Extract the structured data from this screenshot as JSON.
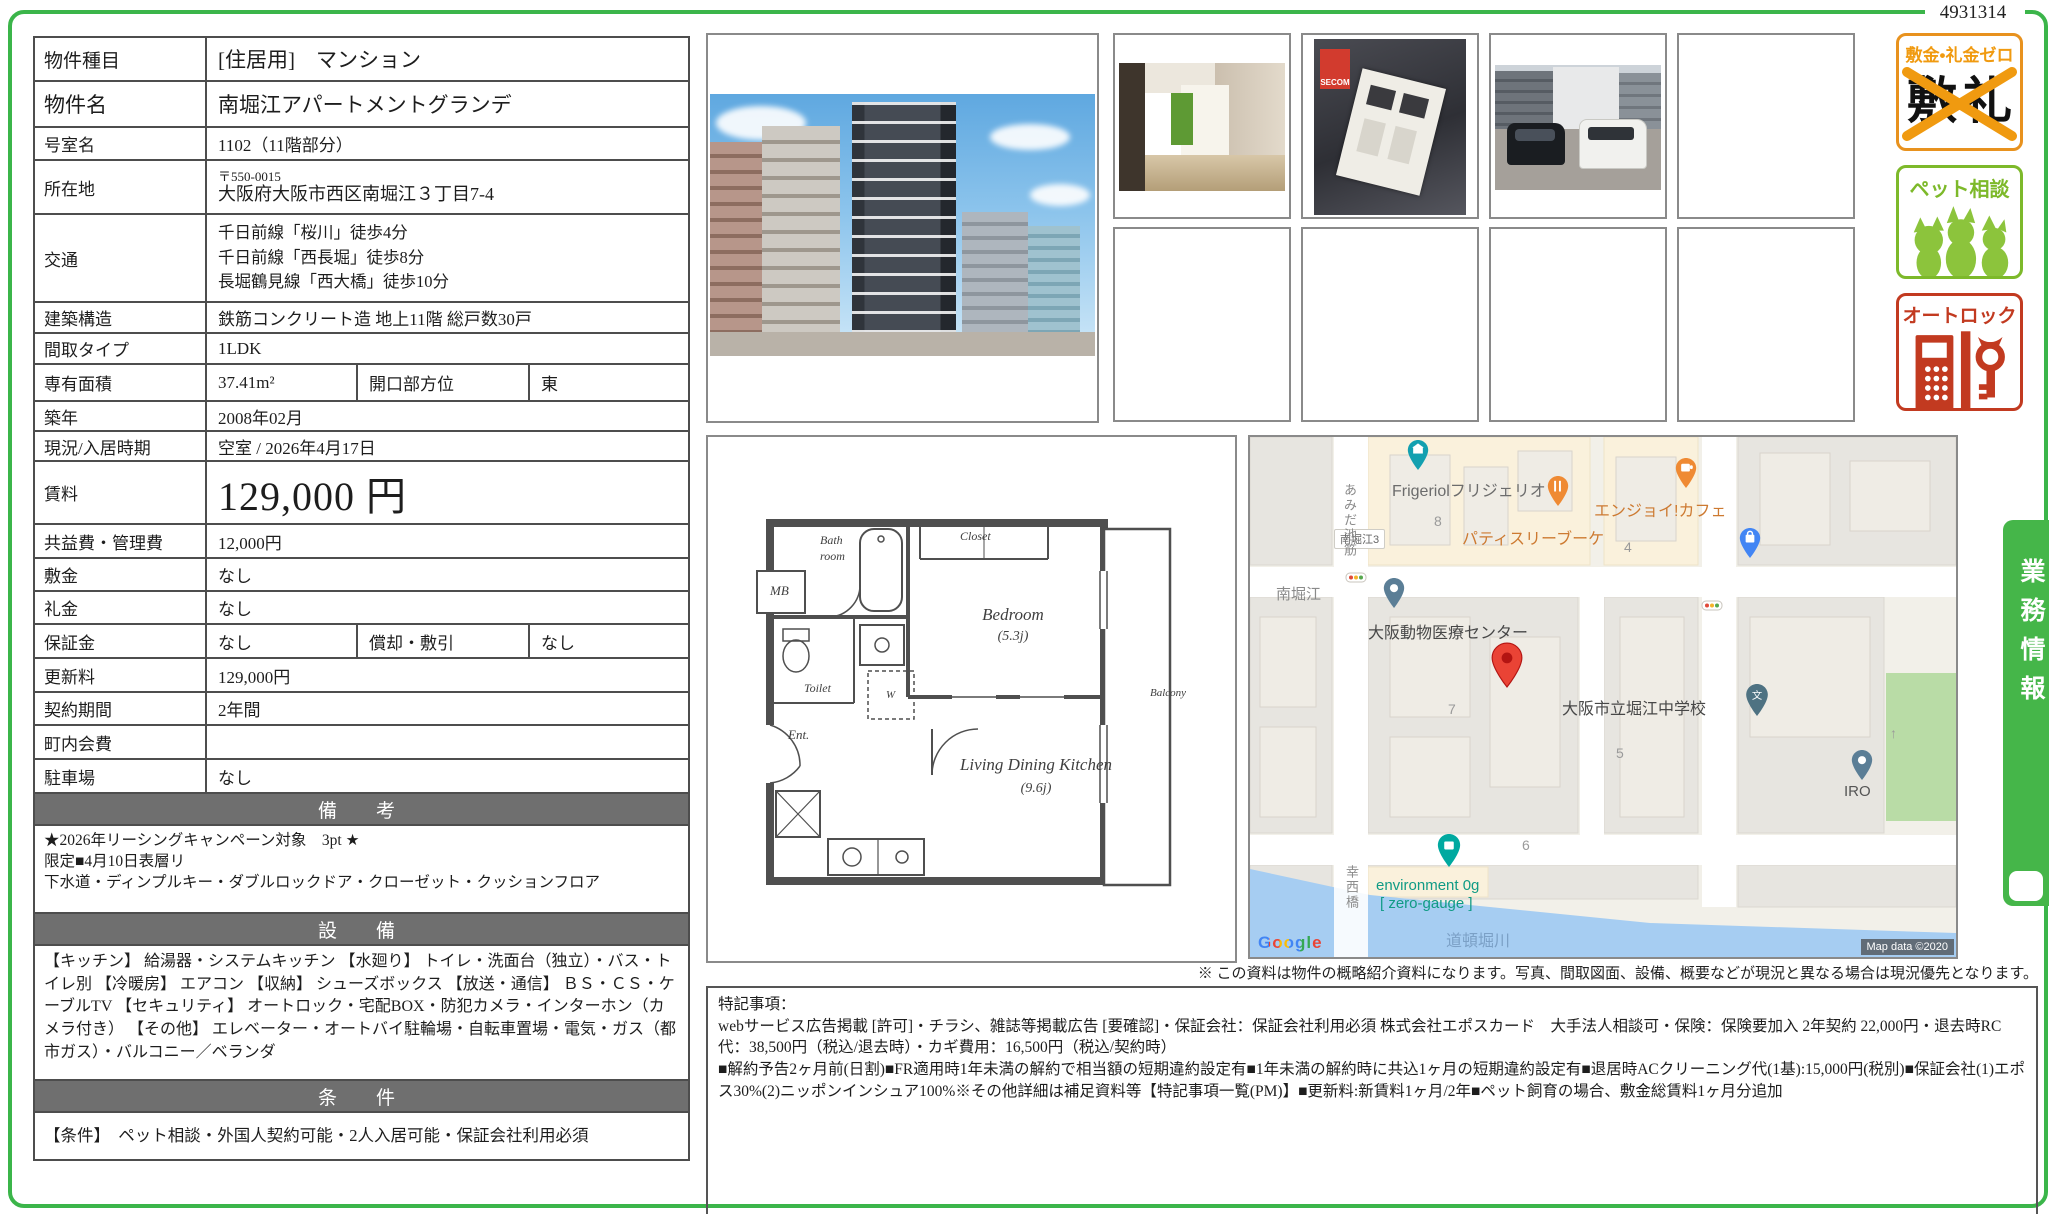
{
  "page": {
    "id_number": "4931314",
    "disclaimer": "※ この資料は物件の概略紹介資料になります。写真、間取図面、設備、概要などが現況と異なる場合は現況優先となります。"
  },
  "table": {
    "rows": [
      {
        "label": "物件種目",
        "value": "[住居用]　マンション"
      },
      {
        "label": "物件名",
        "value": "南堀江アパートメントグランデ"
      },
      {
        "label": "号室名",
        "value": "1102（11階部分）"
      },
      {
        "label": "所在地",
        "postal": "〒550-0015",
        "value": "大阪府大阪市西区南堀江３丁目7-4"
      },
      {
        "label": "交通",
        "line1": "千日前線「桜川」徒歩4分",
        "line2": "千日前線「西長堀」徒歩8分",
        "line3": "長堀鶴見線「西大橋」徒歩10分"
      },
      {
        "label": "建築構造",
        "value": "鉄筋コンクリート造 地上11階 総戸数30戸"
      },
      {
        "label": "間取タイプ",
        "value": "1LDK"
      },
      {
        "label": "専有面積",
        "value": "37.41m²",
        "label2": "開口部方位",
        "value2": "東"
      },
      {
        "label": "築年",
        "value": "2008年02月"
      },
      {
        "label": "現況/入居時期",
        "value": "空室 / 2026年4月17日"
      },
      {
        "label": "賃料",
        "value": "129,000 円"
      },
      {
        "label": "共益費・管理費",
        "value": "12,000円"
      },
      {
        "label": "敷金",
        "value": "なし"
      },
      {
        "label": "礼金",
        "value": "なし"
      },
      {
        "label": "保証金",
        "value": "なし",
        "label2": "償却・敷引",
        "value2": "なし"
      },
      {
        "label": "更新料",
        "value": "129,000円"
      },
      {
        "label": "契約期間",
        "value": "2年間"
      },
      {
        "label": "町内会費",
        "value": ""
      },
      {
        "label": "駐車場",
        "value": "なし"
      }
    ],
    "sections": {
      "remarks_header": "備　考",
      "remarks_line1": "★2026年リーシングキャンペーン対象　3pt ★",
      "remarks_line2": "限定■4月10日表層リ",
      "remarks_line3": "下水道・ディンプルキー・ダブルロックドア・クローゼット・クッションフロア",
      "equipment_header": "設　備",
      "equipment_text": "【キッチン】 給湯器・システムキッチン 【水廻り】 トイレ・洗面台（独立）・バス・トイレ別 【冷暖房】 エアコン 【収納】 シューズボックス 【放送・通信】 ＢＳ・ＣＳ・ケーブルTV 【セキュリティ】 オートロック・宅配BOX・防犯カメラ・インターホン（カメラ付き） 【その他】 エレベーター・オートバイ駐輪場・自転車置場・電気・ガス（都市ガス）・バルコニー／ベランダ",
      "conditions_header": "条　件",
      "conditions_text": "【条件】　ペット相談・外国人契約可能・2人入居可能・保証会社利用必須"
    }
  },
  "photos": {
    "secom_label": "SECOM"
  },
  "floorplan": {
    "mb": "MB",
    "bath1": "Bath",
    "bath2": "room",
    "closet": "Closet",
    "bedroom": "Bedroom",
    "bedroom_size": "(5.3j)",
    "toilet": "Toilet",
    "washer": "W",
    "entrance": "Ent.",
    "ldk": "Living Dining Kitchen",
    "ldk_size": "(9.6j)",
    "balcony": "Balcony"
  },
  "map": {
    "frigeriol": "Frigeriolフリジェリオ",
    "block8": "8",
    "block4": "4",
    "block7": "7",
    "block5": "5",
    "block6": "6",
    "patisserie": "パティスリーブーケ",
    "cafe": "エンジョイ!カフェ",
    "sign": "南堀江3",
    "minamihorie": "南堀江",
    "amidasuji": "あみだ池筋",
    "hospital": "大阪動物医療センター",
    "school": "大阪市立堀江中学校",
    "school_mark": "文",
    "env1": "environment 0g",
    "env2": "[ zero-gauge ]",
    "bridge": "幸西橋",
    "river": "道頓堀川",
    "iro": "IRO",
    "arrow": "↑",
    "google": "Google",
    "attribution": "Map data ©2020"
  },
  "badges": {
    "b1_title": "敷金•礼金ゼロ",
    "b1_kanji1": "敷",
    "b1_kanji2": "礼",
    "b2_title": "ペット相談",
    "b3_title": "オートロック"
  },
  "side_tab": "業務情報",
  "tokki": {
    "title": "特記事項：",
    "para1": "webサービス広告掲載 [許可]・チラシ、雑誌等掲載広告 [要確認]・保証会社：保証会社利用必須 株式会社エポスカード　大手法人相談可・保険：保険要加入 2年契約 22,000円・退去時RC代：38,500円（税込/退去時）・カギ費用：16,500円（税込/契約時）",
    "para2": "■解約予告2ヶ月前(日割)■FR適用時1年未満の解約で相当額の短期違約設定有■1年未満の解約時に共込1ヶ月の短期違約設定有■退居時ACクリーニング代(1基):15,000円(税別)■保証会社(1)エポス30%(2)ニッポンインシュア100%※その他詳細は補足資料等【特記事項一覧(PM)】■更新料:新賃料1ヶ月/2年■ペット飼育の場合、敷金総賃料1ヶ月分追加"
  }
}
